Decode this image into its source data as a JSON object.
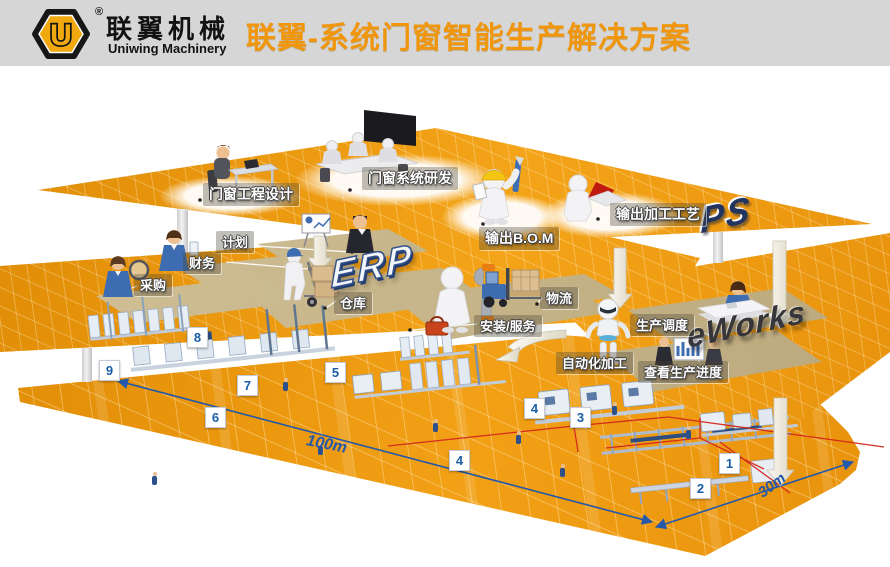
{
  "header": {
    "logo_letter": "U",
    "reg_mark": "®",
    "brand_cn": "联翼机械",
    "brand_en": "Uniwing Machinery",
    "title": "联翼-系统门窗智能生产解决方案"
  },
  "layers": {
    "ps": {
      "tag": "PS",
      "stations": {
        "design": "门窗工程设计",
        "rnd": "门窗系统研发",
        "bom": "输出B.O.M",
        "craft": "输出加工工艺"
      }
    },
    "erp": {
      "tag": "ERP",
      "stations": {
        "plan": "计划",
        "finance": "财务",
        "purchase": "采购",
        "warehouse": "仓库",
        "install": "安装/服务",
        "logistics": "物流"
      }
    },
    "eworks": {
      "tag": "eWorks",
      "stations": {
        "dispatch": "生产调度",
        "auto": "自动化加工",
        "progress": "查看生产进度"
      }
    }
  },
  "floor": {
    "markers": {
      "m1": "1",
      "m2": "2",
      "m3": "3",
      "m4a": "4",
      "m4b": "4",
      "m5": "5",
      "m6": "6",
      "m7": "7",
      "m8": "8",
      "m9": "9"
    },
    "dims": {
      "length": "100m",
      "width": "30m"
    }
  },
  "colors": {
    "platform_orange": "#EA940E",
    "title_orange": "#F0960D",
    "marker_blue": "#1B5EA8",
    "dimension_blue": "#2458A8",
    "route_red": "#D3281C",
    "block_tan": "#CDBB92",
    "header_gray": "#D6D6D6"
  }
}
